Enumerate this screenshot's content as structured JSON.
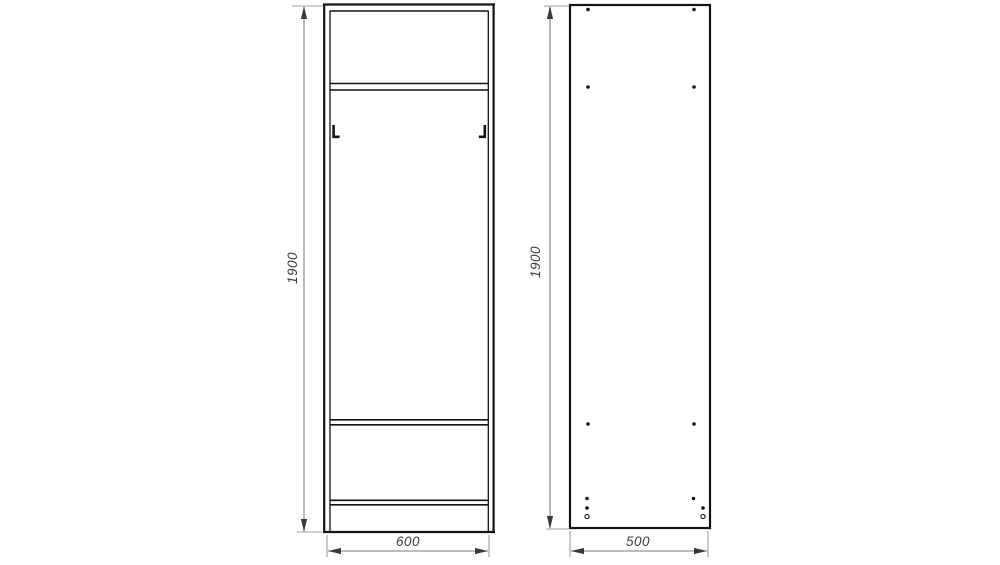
{
  "drawing": {
    "views": {
      "front": {
        "label": "front-view",
        "height_dim": "1900",
        "width_dim": "600"
      },
      "side": {
        "label": "side-view",
        "height_dim": "1900",
        "width_dim": "500"
      }
    },
    "colors": {
      "background": "#ffffff",
      "outline": "#141414",
      "dimension_line": "#7d7d7d",
      "extension_line": "#9d9d9d",
      "dimension_text": "#3c3c3c"
    }
  }
}
